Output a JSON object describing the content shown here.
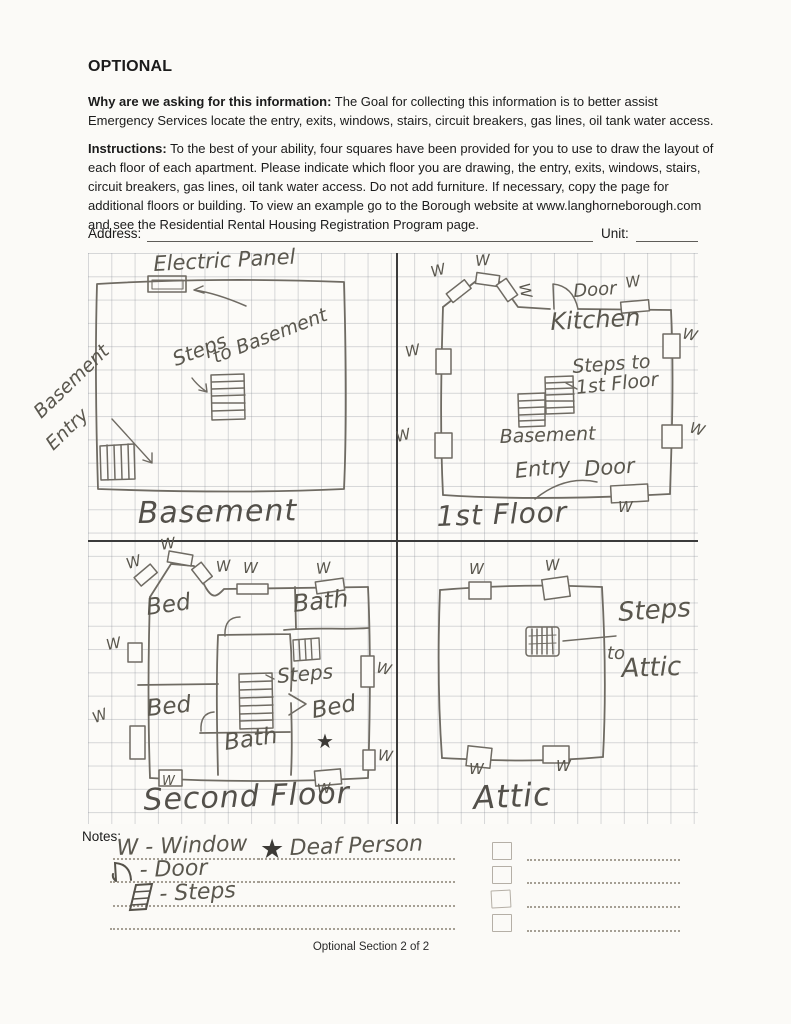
{
  "header": {
    "title": "OPTIONAL",
    "why_bold": "Why are we asking for this information:",
    "why_text": " The Goal for collecting this information is to better assist Emergency Services locate the entry, exits, windows, stairs, circuit breakers, gas lines, oil tank water access.",
    "instructions_bold": "Instructions:",
    "instructions_text": " To the best of your ability, four squares have been provided for you to use to draw the layout of each floor of each apartment. Please indicate which floor you are drawing, the entry, exits, windows, stairs, circuit breakers, gas lines, oil tank water access. Do not add furniture. If necessary, copy the page for additional floors or building. To view an example go to the Borough website at www.langhorneborough.com and see the Residential Rental Housing Registration Program page."
  },
  "address_row": {
    "address_label": "Address:",
    "unit_label": "Unit:"
  },
  "symbols": {
    "w": "W",
    "star": "★"
  },
  "floorplans": {
    "basement": {
      "title": "Basement",
      "electric_panel": "Electric Panel",
      "steps_line1": "Steps",
      "steps_line2": "to Basement",
      "entry_line1": "Basement",
      "entry_line2": "Entry"
    },
    "first_floor": {
      "title": "1st Floor",
      "door_top": "Door",
      "kitchen": "Kitchen",
      "steps_line1": "Steps to",
      "steps_line2": "1st Floor",
      "basement": "Basement",
      "entry": "Entry",
      "entry_door": "Door"
    },
    "second_floor": {
      "title": "Second Floor",
      "bed_top": "Bed",
      "bath_top": "Bath",
      "bed_mid": "Bed",
      "bed_right": "Bed",
      "bath_bottom": "Bath",
      "steps": "Steps"
    },
    "attic": {
      "title": "Attic",
      "steps_line1": "Steps",
      "steps_line2": "to",
      "steps_line3": "Attic"
    }
  },
  "notes": {
    "label": "Notes:",
    "legend_window": "W - Window",
    "legend_door": "- Door",
    "legend_steps": "- Steps",
    "deaf_person": "Deaf Person"
  },
  "footer": {
    "text": "Optional Section 2 of 2"
  }
}
